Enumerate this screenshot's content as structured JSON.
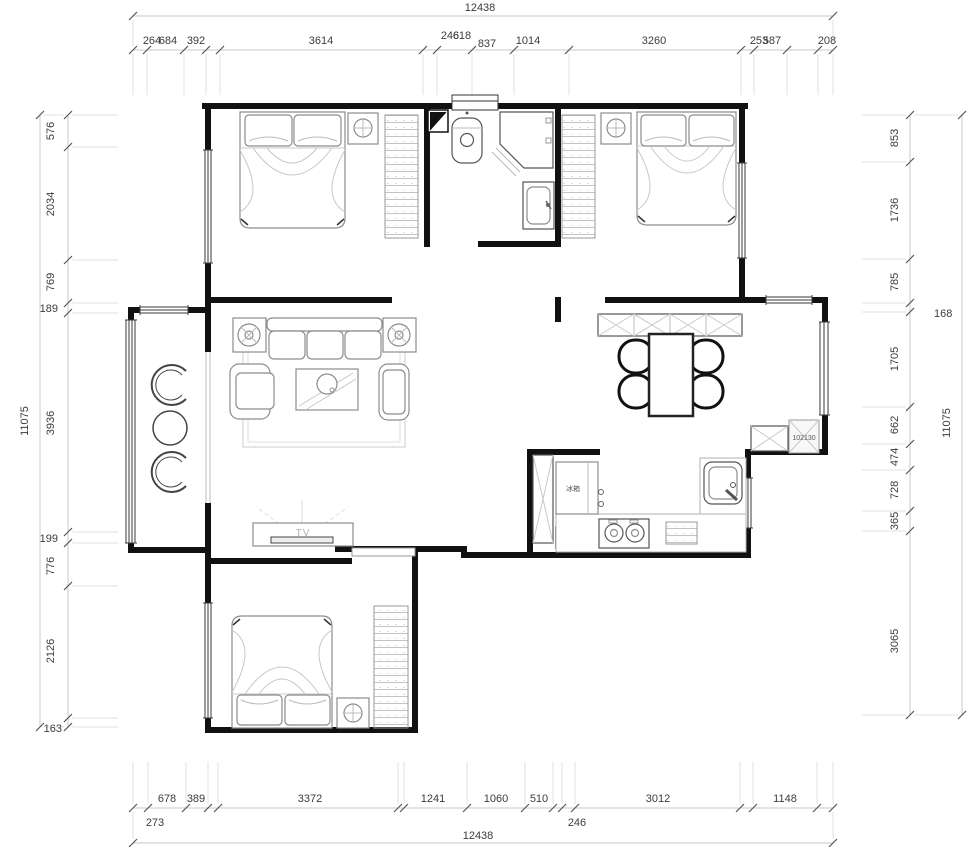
{
  "dims": {
    "top_total": "12438",
    "bottom_total": "12438",
    "left_total": "11075",
    "right_total": "11075",
    "top": [
      "264",
      "684",
      "392",
      "3614",
      "246",
      "618",
      "837",
      "1014",
      "3260",
      "253",
      "587",
      "208"
    ],
    "bottom": [
      "678",
      "389",
      "3372",
      "1241",
      "1060",
      "510",
      "3012",
      "1148"
    ],
    "bottom2": [
      "273",
      "246"
    ],
    "left": [
      "576",
      "2034",
      "769",
      "3936",
      "776",
      "2126"
    ],
    "left_h": [
      "189",
      "199",
      "163"
    ],
    "right": [
      "853",
      "1736",
      "785",
      "1705",
      "662",
      "474",
      "728",
      "365",
      "3065"
    ],
    "right_h": [
      "168"
    ]
  },
  "labels": {
    "tv": "TV",
    "fridge": "冰箱",
    "nook_note": "102130"
  },
  "colors": {
    "wall": "#111111",
    "dim_line": "#c9c9c9",
    "dim_text": "#3c3c3c",
    "furniture": "#8c8c8c"
  }
}
